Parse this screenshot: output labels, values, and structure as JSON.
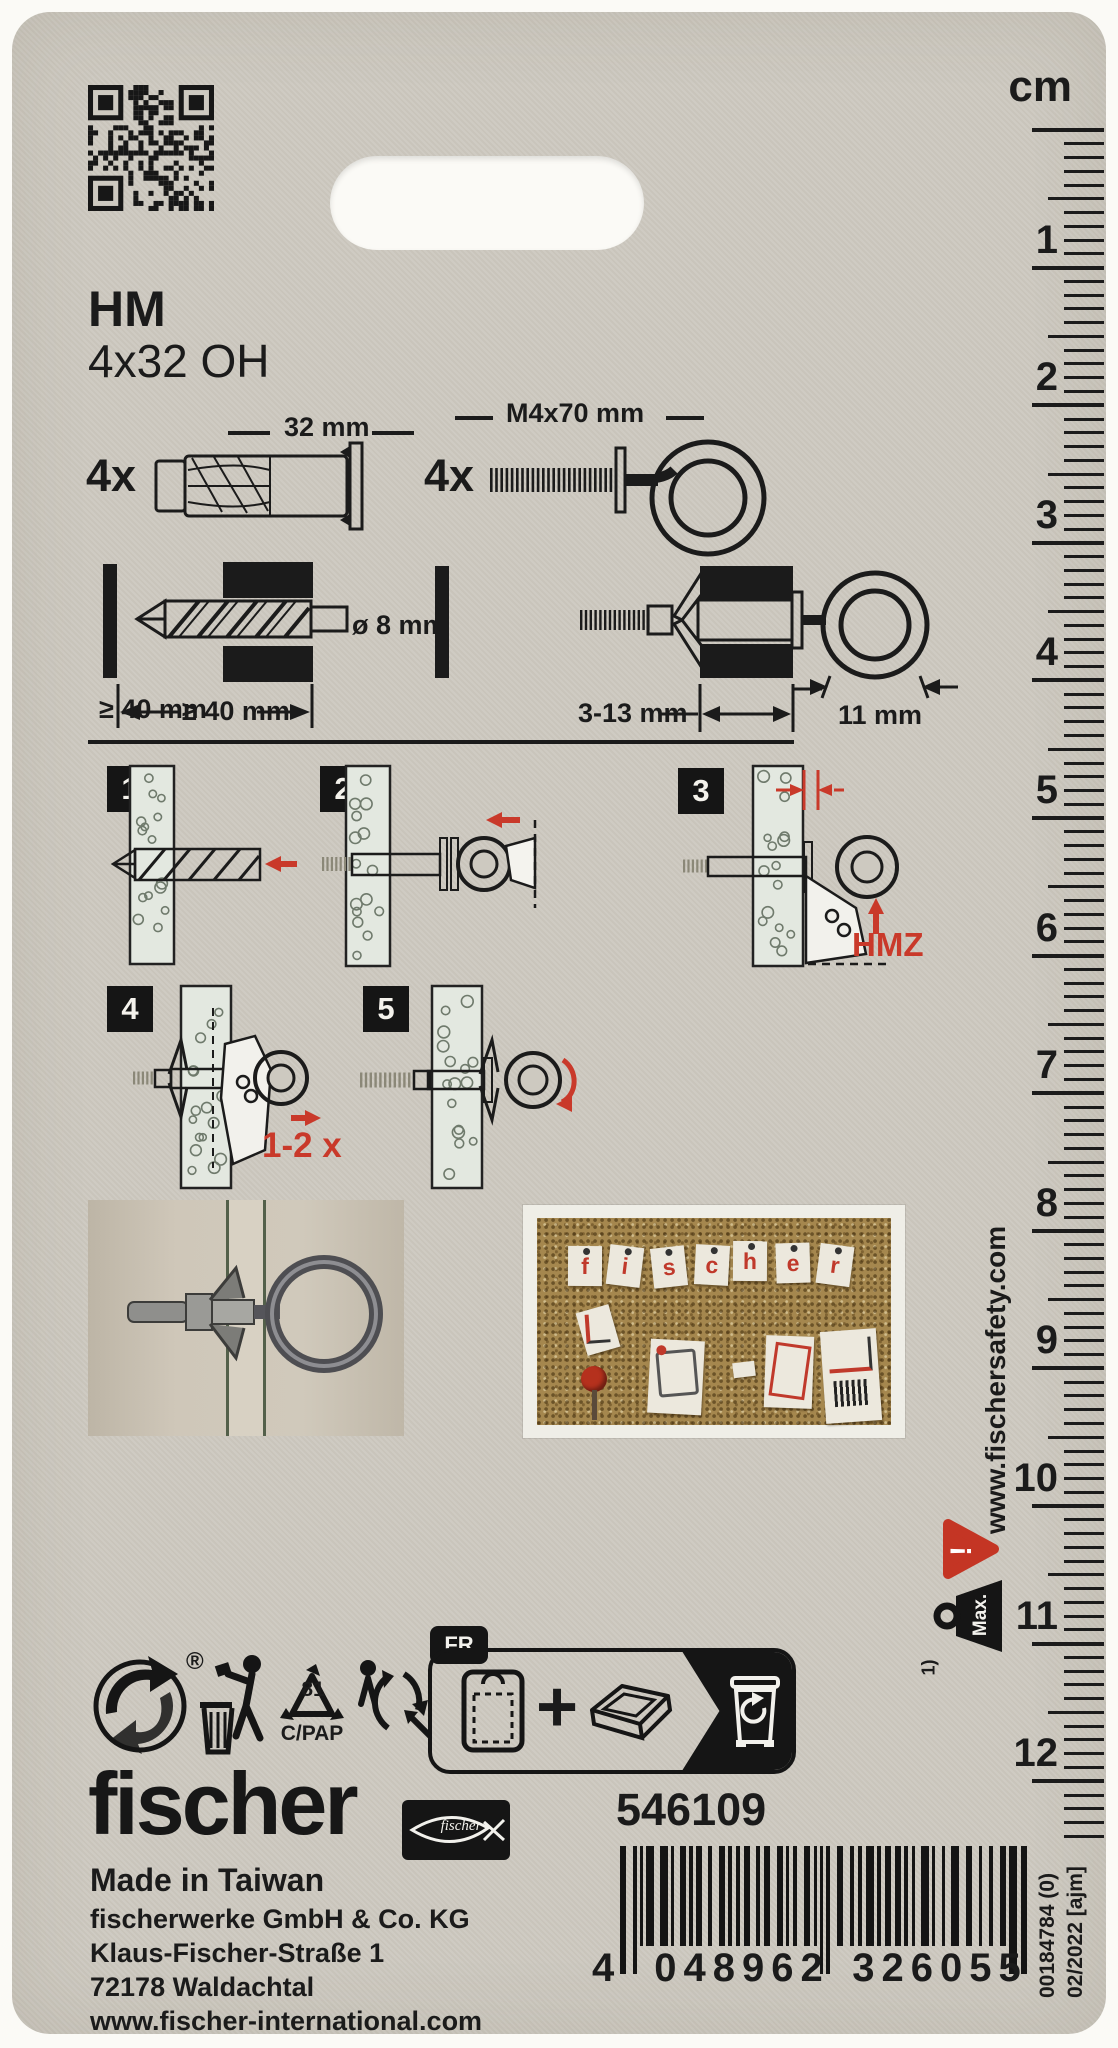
{
  "product": {
    "series": "HM",
    "size": "4x32 OH"
  },
  "contents": {
    "anchor": {
      "qty": "4x",
      "dim": "32 mm"
    },
    "eyebolt": {
      "qty": "4x",
      "dim": "M4x70 mm"
    }
  },
  "installation": {
    "drill_diameter": "ø 8 mm",
    "min_hole_depth": "≥ 40 mm",
    "material_thickness": "3-13 mm",
    "eye_inner_diameter": "11 mm"
  },
  "steps": {
    "numbers": [
      "1",
      "2",
      "3",
      "4",
      "5"
    ],
    "tool_label": "HMZ",
    "repeat_label": "1-2 x"
  },
  "ruler": {
    "unit": "cm",
    "numbers": [
      "1",
      "2",
      "3",
      "4",
      "5",
      "6",
      "7",
      "8",
      "9",
      "10",
      "11",
      "12"
    ]
  },
  "sidebar": {
    "url": "www.fischersafety.com",
    "warning": "!",
    "max_label": "Max.",
    "footnote": "1)"
  },
  "recycling": {
    "registered": "®",
    "resin_code": "81",
    "material_code": "C/PAP",
    "country_tab": "FR"
  },
  "pinboard_letters": [
    "f",
    "i",
    "s",
    "c",
    "h",
    "e",
    "r"
  ],
  "footer": {
    "brand": "fischer",
    "logo_script": "fischer",
    "article_number": "546109",
    "origin": "Made in Taiwan",
    "company": "fischerwerke GmbH & Co. KG",
    "street": "Klaus-Fischer-Straße 1",
    "city": "72178 Waldachtal",
    "website": "www.fischer-international.com"
  },
  "barcode": {
    "digit_lead": "4",
    "digit_group1": "048962",
    "digit_group2": "326055",
    "print_ref": "00184784 (0)",
    "date_code": "02/2022 [ajm]"
  },
  "colors": {
    "accent_red": "#c9392a",
    "card": "#cdc9c0"
  }
}
